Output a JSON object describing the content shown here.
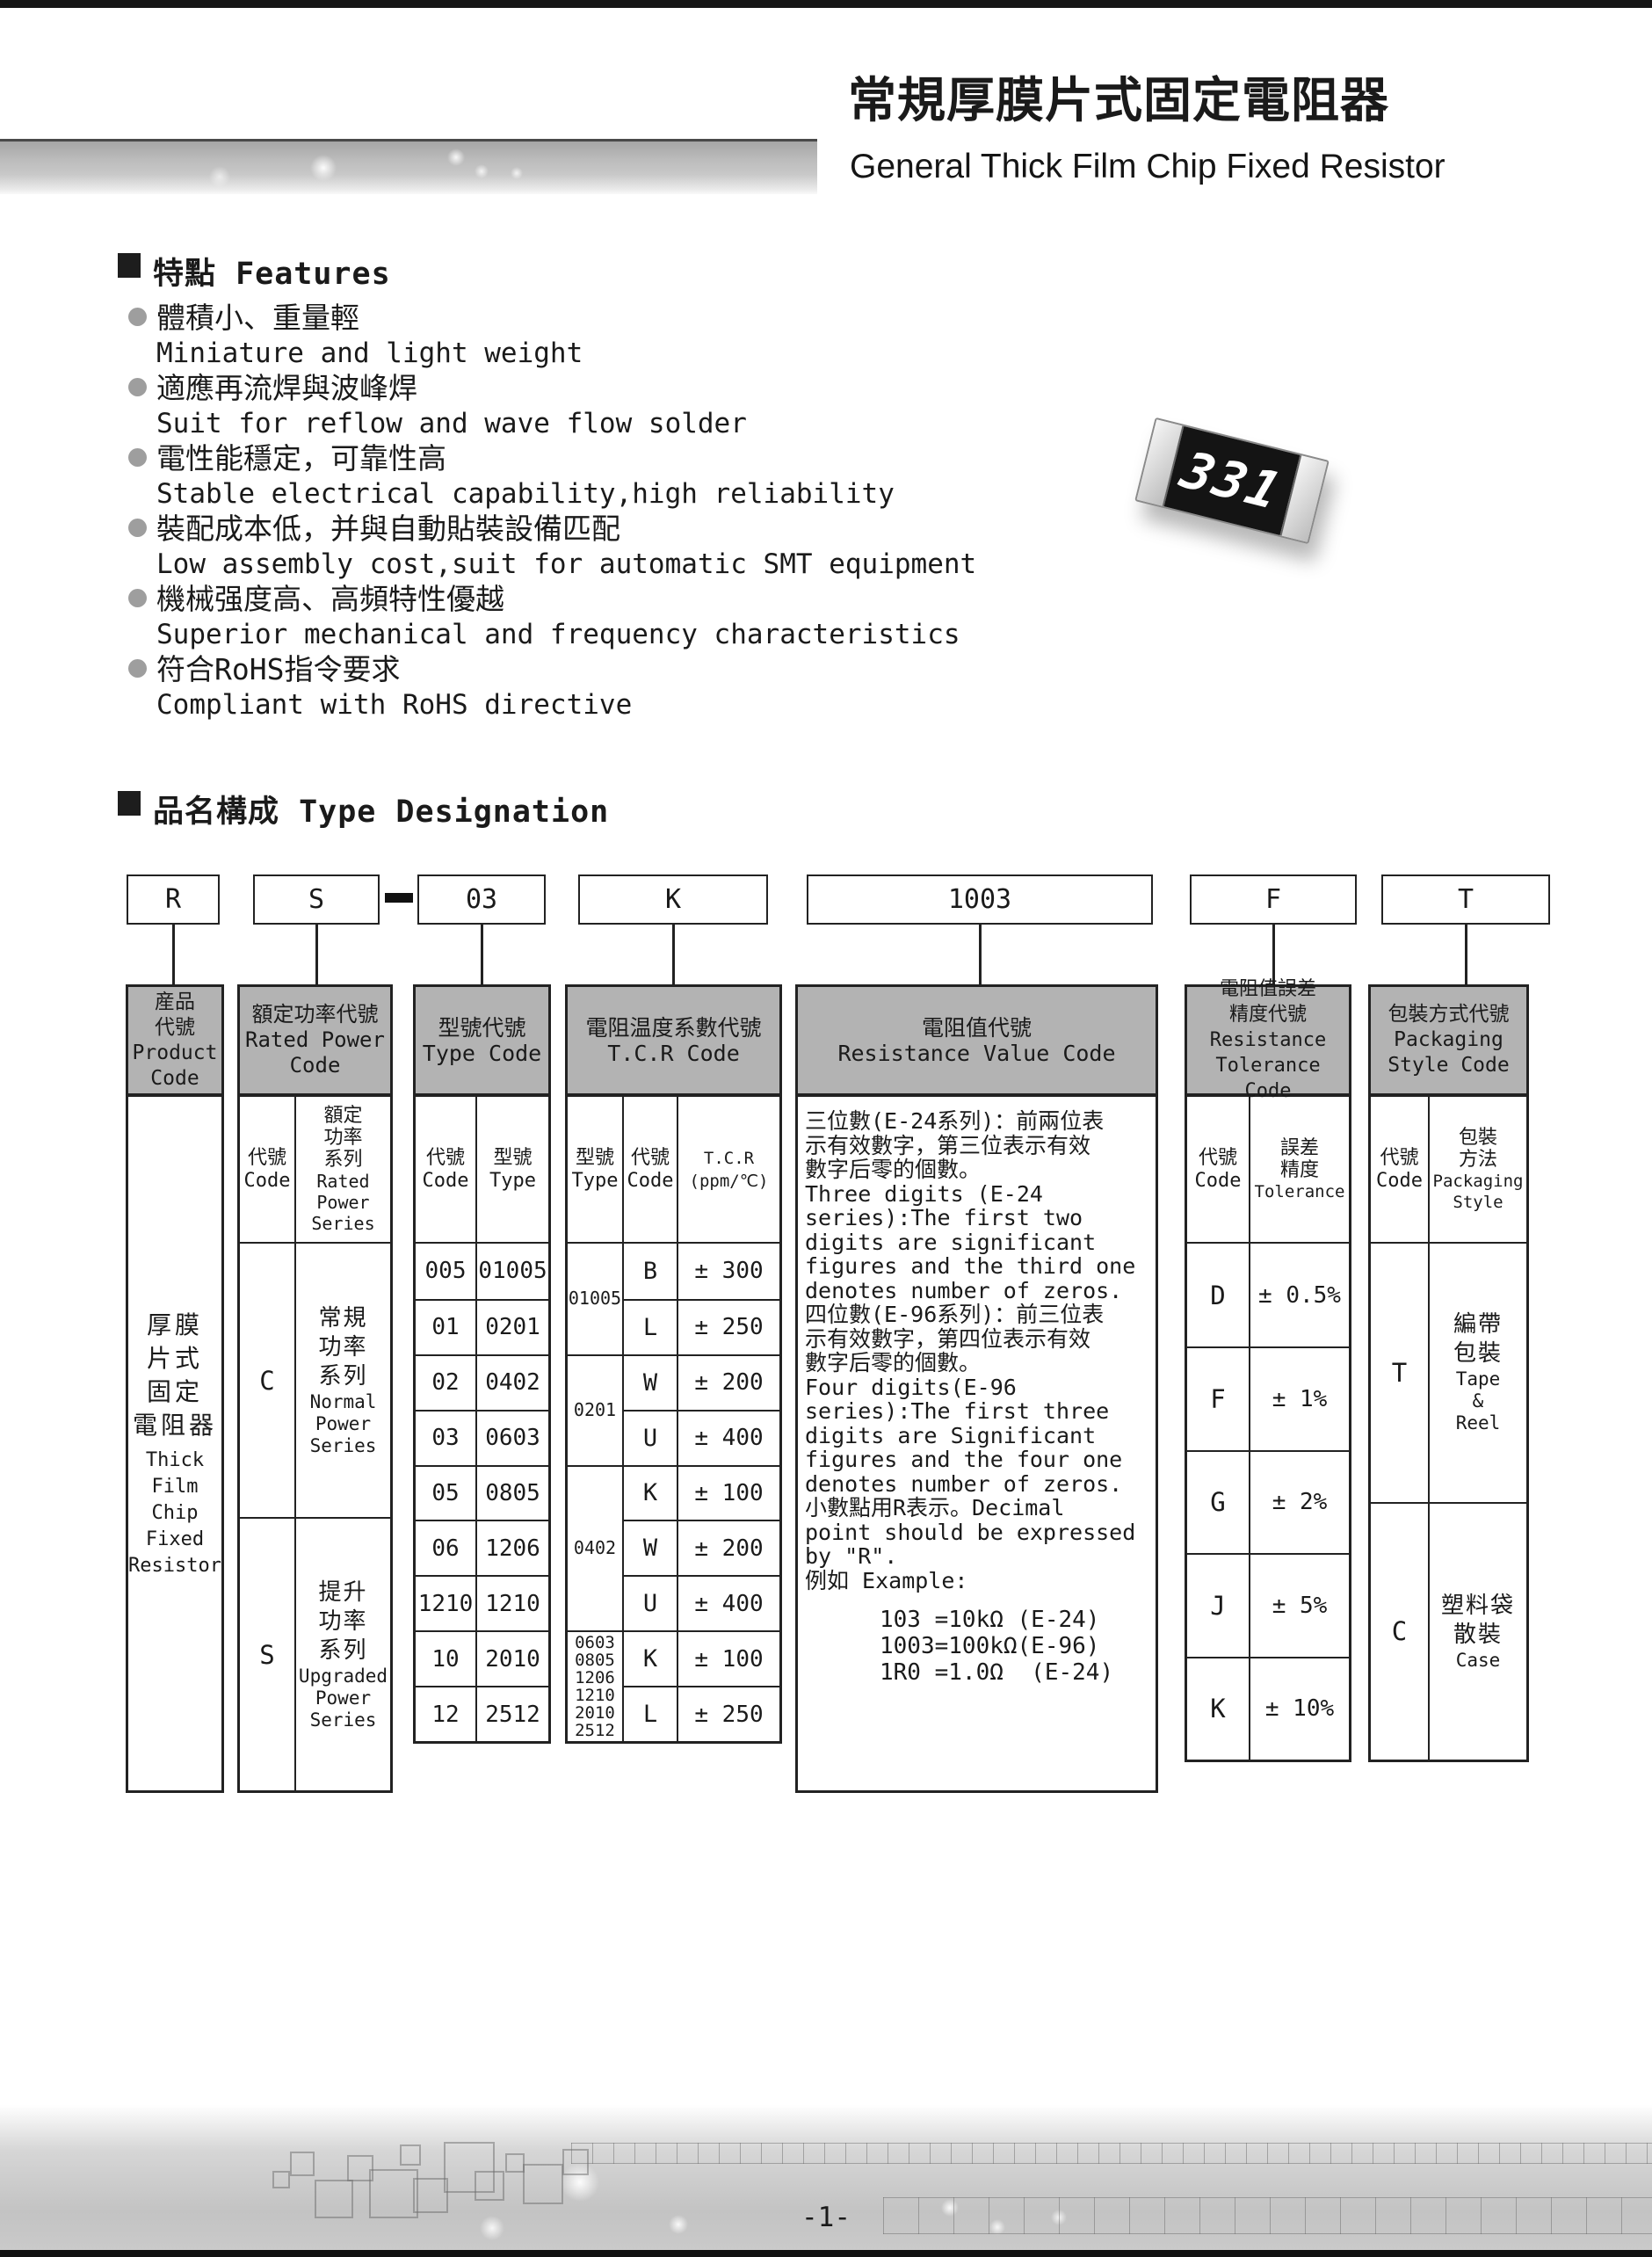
{
  "header": {
    "title_cn": "常規厚膜片式固定電阻器",
    "title_en": "General Thick Film Chip Fixed Resistor"
  },
  "features": {
    "heading": "特點 Features",
    "items": [
      {
        "cn": "體積小、重量輕",
        "en": "Miniature and light weight"
      },
      {
        "cn": "適應再流焊與波峰焊",
        "en": "Suit for reflow and wave flow solder"
      },
      {
        "cn": "電性能穩定，可靠性高",
        "en": "Stable electrical capability,high reliability"
      },
      {
        "cn": "裝配成本低，并與自動貼裝設備匹配",
        "en": "Low assembly cost,suit for automatic SMT equipment"
      },
      {
        "cn": "機械强度高、高頻特性優越",
        "en": "Superior mechanical and frequency characteristics"
      },
      {
        "cn": "符合RoHS指令要求",
        "en": "Compliant with RoHS directive"
      }
    ]
  },
  "resistor": {
    "marking": "331"
  },
  "type_designation": {
    "heading": "品名構成  Type Designation",
    "code_boxes": [
      "R",
      "S",
      "03",
      "K",
      "1003",
      "F",
      "T"
    ]
  },
  "table": {
    "product": {
      "header": [
        "産品",
        "代號",
        "Product",
        "Code"
      ],
      "body_cn": [
        "厚膜",
        "片式",
        "固定",
        "電阻器"
      ],
      "body_en": [
        "Thick",
        "Film",
        "Chip",
        "Fixed",
        "Resistor"
      ]
    },
    "rated_power": {
      "header": [
        "額定功率代號",
        "Rated Power",
        "Code"
      ],
      "sub_code": [
        "代號",
        "Code"
      ],
      "sub_series_cn": [
        "額定",
        "功率",
        "系列"
      ],
      "sub_series_en": [
        "Rated",
        "Power",
        "Series"
      ],
      "rows": [
        {
          "code": "C",
          "series_cn": [
            "常規",
            "功率",
            "系列"
          ],
          "series_en": [
            "Normal",
            "Power",
            "Series"
          ]
        },
        {
          "code": "S",
          "series_cn": [
            "提升",
            "功率",
            "系列"
          ],
          "series_en": [
            "Upgraded",
            "Power",
            "Series"
          ]
        }
      ]
    },
    "type_code": {
      "header": [
        "型號代號",
        "Type Code"
      ],
      "sub_code": [
        "代號",
        "Code"
      ],
      "sub_type": [
        "型號",
        "Type"
      ],
      "rows": [
        [
          "005",
          "01005"
        ],
        [
          "01",
          "0201"
        ],
        [
          "02",
          "0402"
        ],
        [
          "03",
          "0603"
        ],
        [
          "05",
          "0805"
        ],
        [
          "06",
          "1206"
        ],
        [
          "1210",
          "1210"
        ],
        [
          "10",
          "2010"
        ],
        [
          "12",
          "2512"
        ]
      ]
    },
    "tcr": {
      "header": [
        "電阻温度系數代號",
        "T.C.R Code"
      ],
      "sub_type": [
        "型號",
        "Type"
      ],
      "sub_code": [
        "代號",
        "Code"
      ],
      "sub_tcr": [
        "T.C.R",
        "(ppm/℃)"
      ],
      "groups": [
        {
          "type": [
            "01005"
          ],
          "rows": [
            [
              "B",
              "± 300"
            ],
            [
              "L",
              "± 250"
            ]
          ]
        },
        {
          "type": [
            "0201"
          ],
          "rows": [
            [
              "W",
              "± 200"
            ],
            [
              "U",
              "± 400"
            ]
          ]
        },
        {
          "type": [
            "0402"
          ],
          "rows": [
            [
              "K",
              "± 100"
            ],
            [
              "W",
              "± 200"
            ],
            [
              "U",
              "± 400"
            ]
          ]
        },
        {
          "type": [
            "0603",
            "0805",
            "1206",
            "1210",
            "2010",
            "2512"
          ],
          "rows": [
            [
              "K",
              "± 100"
            ],
            [
              "L",
              "± 250"
            ]
          ]
        }
      ]
    },
    "resistance_value": {
      "header": [
        "電阻值代號",
        "Resistance Value Code"
      ],
      "lines": [
        "三位數(E-24系列)：前兩位表",
        "示有效數字，第三位表示有效",
        "數字后零的個數。",
        "Three digits (E-24",
        "series):The first two",
        "digits are significant",
        "figures and the third one",
        "denotes number of zeros.",
        "四位數(E-96系列)：前三位表",
        "示有效數字，第四位表示有效",
        "數字后零的個數。",
        "Four digits(E-96",
        "series):The first three",
        "digits are Significant",
        "figures and the four one",
        "denotes number of zeros.",
        "小數點用R表示。Decimal",
        "point should be expressed",
        "by \"R\".",
        "例如 Example:"
      ],
      "examples": [
        "103 =10kΩ (E-24)",
        "1003=100kΩ(E-96)",
        "1R0 =1.0Ω  (E-24)"
      ]
    },
    "tolerance": {
      "header": [
        "電阻值誤差",
        "精度代號",
        "Resistance",
        "Tolerance Code"
      ],
      "sub_code": [
        "代號",
        "Code"
      ],
      "sub_tol_cn": [
        "誤差",
        "精度"
      ],
      "sub_tol_en": [
        "Tolerance"
      ],
      "rows": [
        [
          "D",
          "± 0.5%"
        ],
        [
          "F",
          "± 1%"
        ],
        [
          "G",
          "± 2%"
        ],
        [
          "J",
          "± 5%"
        ],
        [
          "K",
          "± 10%"
        ]
      ]
    },
    "packaging": {
      "header": [
        "包裝方式代號",
        "Packaging",
        "Style Code"
      ],
      "sub_code": [
        "代號",
        "Code"
      ],
      "sub_style_cn": [
        "包裝",
        "方法"
      ],
      "sub_style_en": [
        "Packaging",
        "Style"
      ],
      "rows": [
        {
          "code": "T",
          "style_cn": [
            "編帶",
            "包裝"
          ],
          "style_en": [
            "Tape",
            "&",
            "Reel"
          ]
        },
        {
          "code": "C",
          "style_cn": [
            "塑料袋",
            "散裝"
          ],
          "style_en": [
            "Case"
          ]
        }
      ]
    }
  },
  "footer": {
    "page_number": "-1-"
  }
}
